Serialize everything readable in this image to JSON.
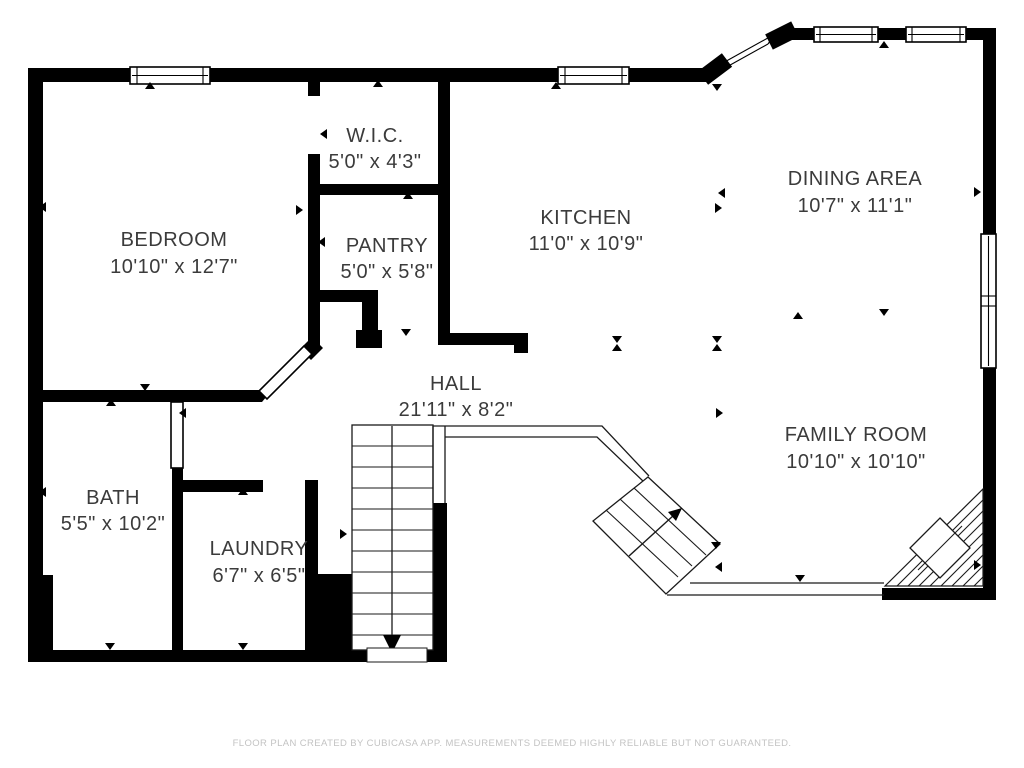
{
  "title": "Floor plan",
  "colors": {
    "background": "#ffffff",
    "wall": "#000000",
    "label_text": "#3b3b3b",
    "footer_text": "#c3c3c3"
  },
  "rooms": {
    "bedroom": {
      "name": "BEDROOM",
      "dims": "10'10\" x 12'7\""
    },
    "wic": {
      "name": "W.I.C.",
      "dims": "5'0\" x 4'3\""
    },
    "pantry": {
      "name": "PANTRY",
      "dims": "5'0\" x 5'8\""
    },
    "kitchen": {
      "name": "KITCHEN",
      "dims": "11'0\" x 10'9\""
    },
    "dining": {
      "name": "DINING AREA",
      "dims": "10'7\" x 11'1\""
    },
    "family": {
      "name": "FAMILY ROOM",
      "dims": "10'10\" x 10'10\""
    },
    "hall": {
      "name": "HALL",
      "dims": "21'11\" x 8'2\""
    },
    "bath": {
      "name": "BATH",
      "dims": "5'5\" x 10'2\""
    },
    "laundry": {
      "name": "LAUNDRY",
      "dims": "6'7\" x 6'5\""
    }
  },
  "footer": {
    "disclaimer": "FLOOR PLAN CREATED BY CUBICASA APP. MEASUREMENTS DEEMED HIGHLY RELIABLE BUT NOT GUARANTEED."
  }
}
